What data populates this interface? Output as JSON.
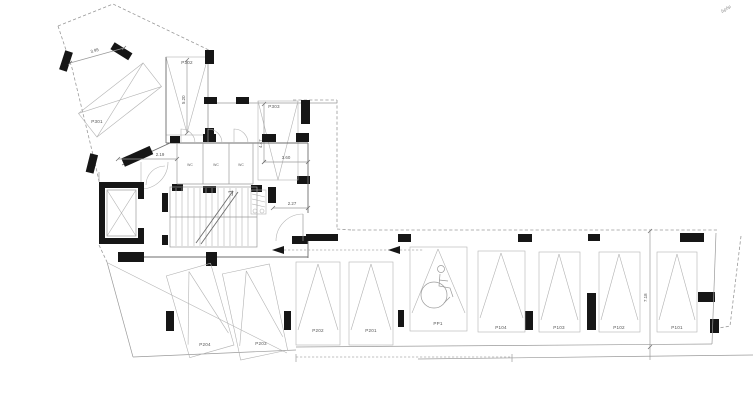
{
  "site_note": "Δρόμ",
  "stalls": {
    "p301": "P301",
    "p302": "P302",
    "p303": "P303",
    "p204": "P204",
    "p203": "P203",
    "p202": "P202",
    "p201": "P201",
    "pp1": "PP1",
    "p104": "P104",
    "p103": "P103",
    "p102": "P102",
    "p101": "P101"
  },
  "rooms": {
    "wc1": "WC",
    "wc2": "WC",
    "wc3": "WC"
  },
  "dims": {
    "d395": "3.95",
    "d520": "5.20",
    "d219": "2.19",
    "d447": "4.47",
    "d360": "3.60",
    "d227": "2.27",
    "d718": "7.18"
  },
  "icons": {
    "wheelchair": "♿",
    "bicycle": "🚲",
    "direction_arrow": "◄",
    "stairs": "stair-flight"
  }
}
